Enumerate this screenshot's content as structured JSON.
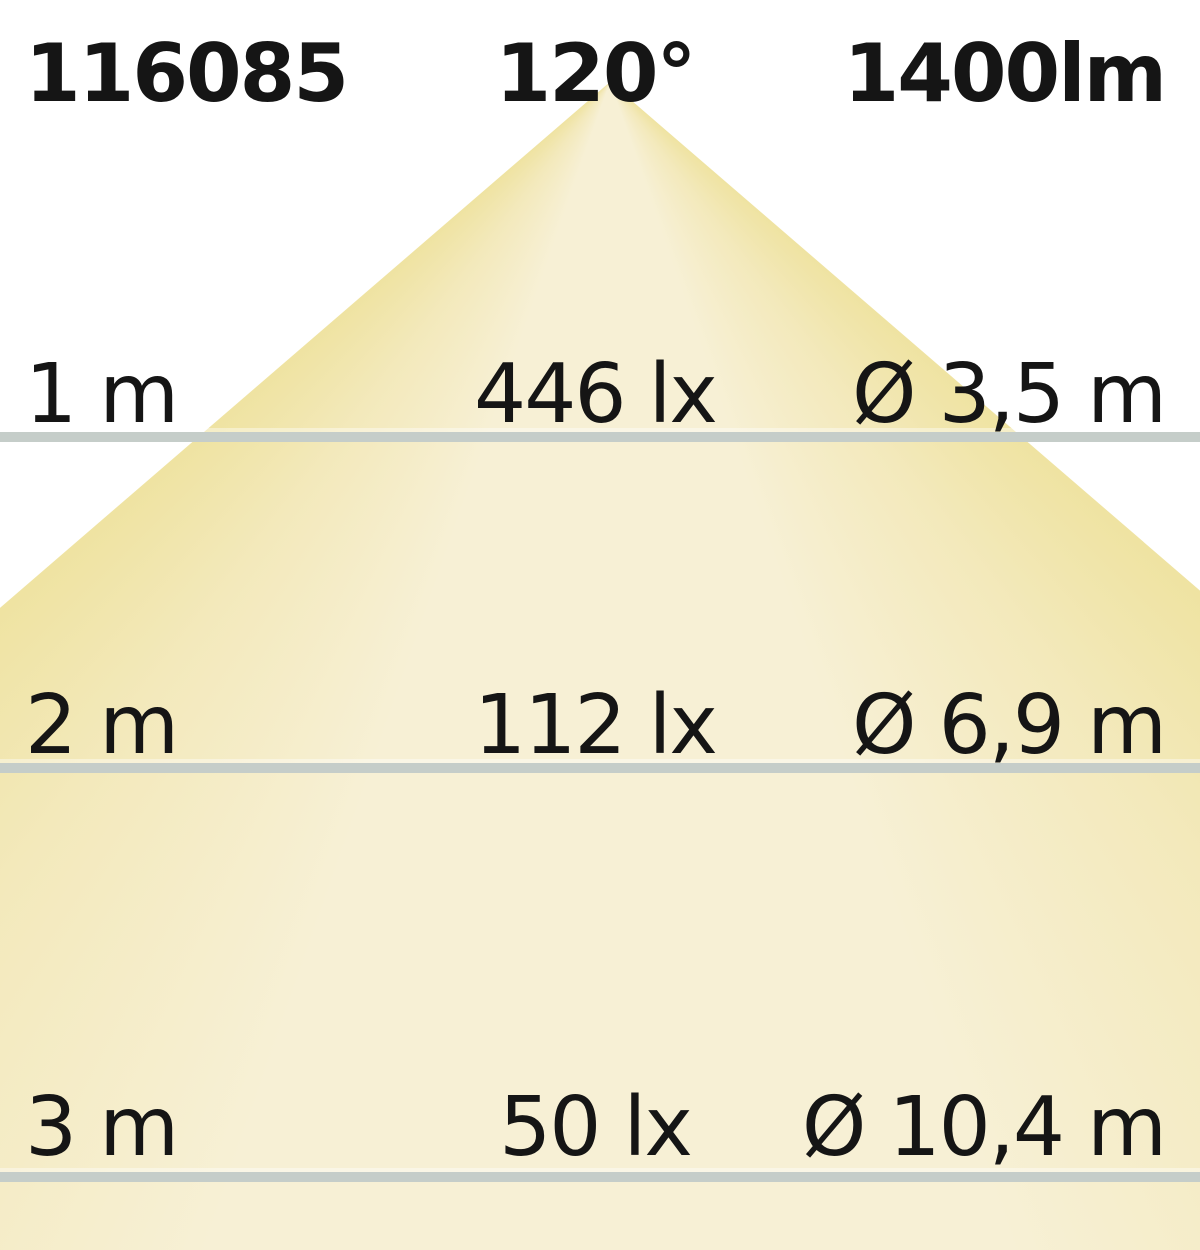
{
  "header": {
    "article_number": "116085",
    "beam_angle": "120°",
    "luminous_flux": "1400lm"
  },
  "rows": [
    {
      "distance": "1 m",
      "illuminance": "446 lx",
      "diameter": "Ø 3,5 m"
    },
    {
      "distance": "2 m",
      "illuminance": "112 lx",
      "diameter": "Ø 6,9 m"
    },
    {
      "distance": "3 m",
      "illuminance": "50 lx",
      "diameter": "Ø 10,4 m"
    }
  ],
  "colors": {
    "bg": "#ffffff",
    "text_color": "#151515",
    "line_color": "#c5cdc9",
    "cone_edge": "#efe3a2",
    "cone_blend": "#f3e9bb",
    "cone_center": "#f7f0d5"
  },
  "chart_data": {
    "type": "table",
    "title": "LED beam illuminance diagram",
    "article_number": "116085",
    "beam_angle_deg": 120,
    "luminous_flux_lm": 1400,
    "columns": [
      "distance",
      "illuminance_lx",
      "beam_diameter_m"
    ],
    "rows": [
      {
        "distance_m": 1,
        "illuminance_lx": 446,
        "beam_diameter_m": 3.5
      },
      {
        "distance_m": 2,
        "illuminance_lx": 112,
        "beam_diameter_m": 6.9
      },
      {
        "distance_m": 3,
        "illuminance_lx": 50,
        "beam_diameter_m": 10.4
      }
    ]
  }
}
